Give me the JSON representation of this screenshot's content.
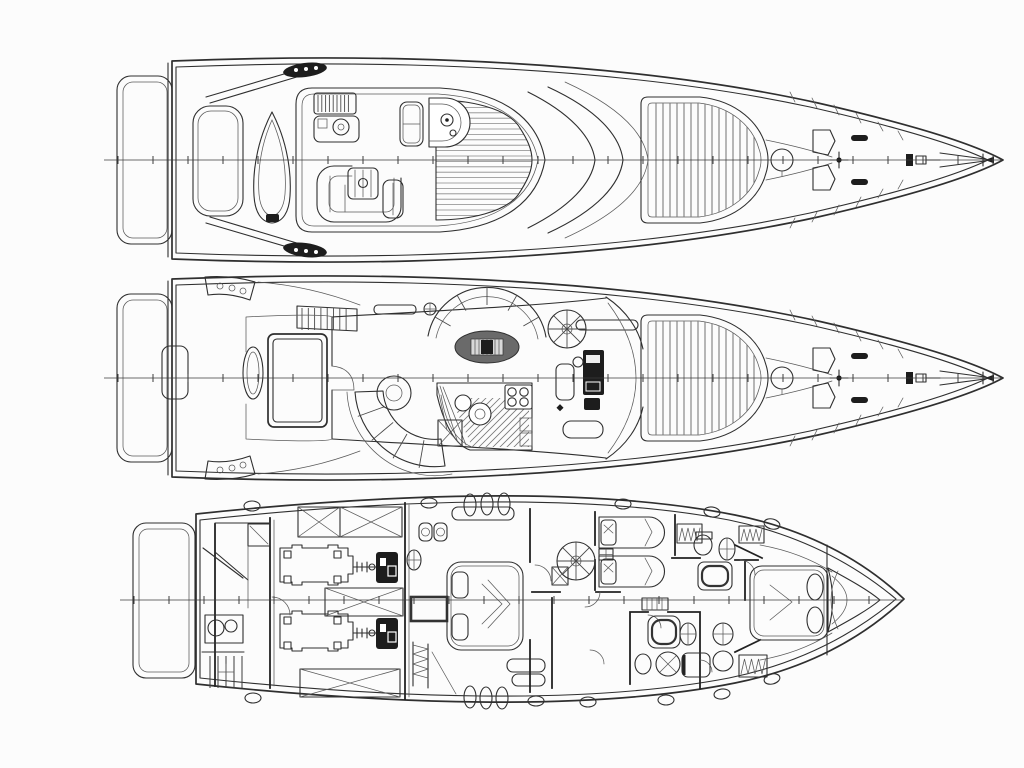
{
  "page": {
    "title": "Motor yacht general arrangement — three deck plans",
    "subtitle": "Line drawing: flybridge, main deck and lower deck layouts on white paper"
  },
  "colors": {
    "paper": "#fcfcfc",
    "ink": "#2f2f2f",
    "dark": "#1d1d1d",
    "mid": "#6a6a6a",
    "slat": "#7d7d7d"
  },
  "views": [
    {
      "id": "flybridge",
      "name": "Flybridge and exterior deck plan (top view)",
      "features": [
        "swim-platform",
        "radar-arch",
        "stowed-tender",
        "wet-bar-with-grill",
        "u-shaped-settee",
        "cocktail-table",
        "bench-seat",
        "helm-pod-with-wheel",
        "teak-planked-deck",
        "windscreen",
        "foredeck-sunpad",
        "round-deck-hatch",
        "bow-lockers",
        "anchor-windlass",
        "bow-pulpit",
        "hull-centerline-with-station-ticks"
      ]
    },
    {
      "id": "main-deck",
      "name": "Main deck plan (salon, galley and cockpit)",
      "features": [
        "swim-platform",
        "transom-step",
        "aft-deck-table",
        "cockpit-sunpad",
        "steps-to-flybridge",
        "side-decks",
        "salon-curved-settee",
        "round-pedestal-table",
        "dinette-arc-sofa",
        "oval-dining-table",
        "spiral-staircase",
        "galley-with-twin-sinks-and-stove",
        "stairwell-down",
        "lower-helm-console",
        "helm-seat",
        "windshield",
        "foredeck-sunpad",
        "round-deck-hatch",
        "anchor-windlass"
      ]
    },
    {
      "id": "lower-deck",
      "name": "Lower deck accommodation and engine room plan",
      "features": [
        "swim-platform",
        "crew-quarters-with-sink-and-ladder",
        "fuel-tanks-crossed",
        "twin-engines-with-gearboxes",
        "generator-mufflers",
        "companionway-stairs",
        "midship-double-cabin",
        "hull-window-band",
        "porthole-group",
        "spiral-staircase-landing",
        "twin-guest-cabin",
        "nightstand",
        "guest-bathroom-shower",
        "day-head",
        "vip-bow-cabin",
        "hanging-wardrobes",
        "chain-locker",
        "deck-cleats"
      ]
    }
  ],
  "annotations": {
    "centerline": "hull centerline with evenly spaced station tick marks",
    "hatching": "diagonal hatching marks galley sole; crossed boxes mark tanks"
  }
}
